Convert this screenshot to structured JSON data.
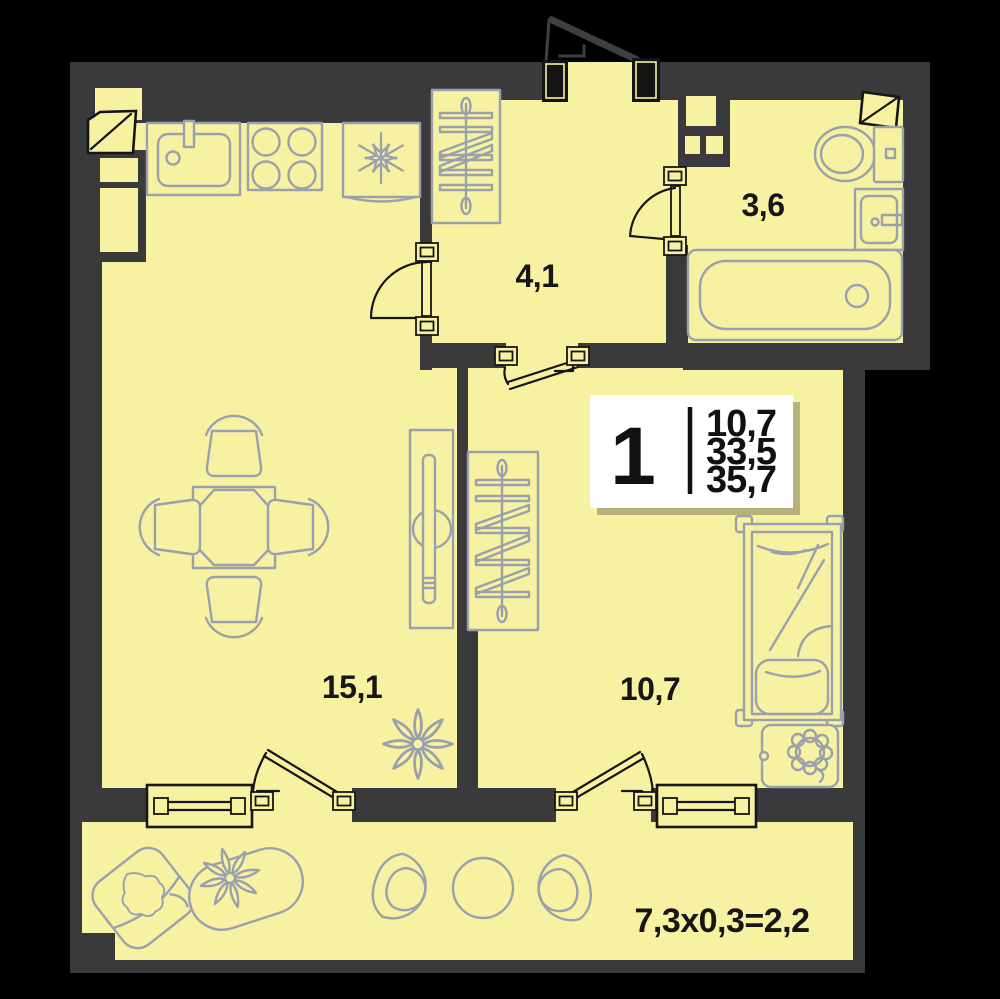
{
  "plan": {
    "rooms": {
      "bathroom": {
        "name": "bathroom",
        "area": "3,6"
      },
      "hallway": {
        "name": "hallway",
        "area": "4,1"
      },
      "living_kitchen": {
        "name": "kitchen-living",
        "area": "15,1"
      },
      "bedroom": {
        "name": "bedroom",
        "area": "10,7"
      },
      "balcony": {
        "name": "balcony",
        "formula": "7,3x0,3=2,2"
      }
    },
    "legend": {
      "rooms_count": "1",
      "values": [
        "10,7",
        "33,5",
        "35,7"
      ]
    },
    "colors": {
      "background": "#000000",
      "walls": "#3a3a3c",
      "floor": "#f7f2a2",
      "furniture_outline": "#9aa0ac",
      "symbols": "#161616",
      "legend_bg": "#ffffff",
      "text": "#161616"
    },
    "icon_glyphs": {
      "fridge": "snowflake",
      "living_flower": "8-petal-flower",
      "planter_flower": "8-petal-flower"
    }
  }
}
